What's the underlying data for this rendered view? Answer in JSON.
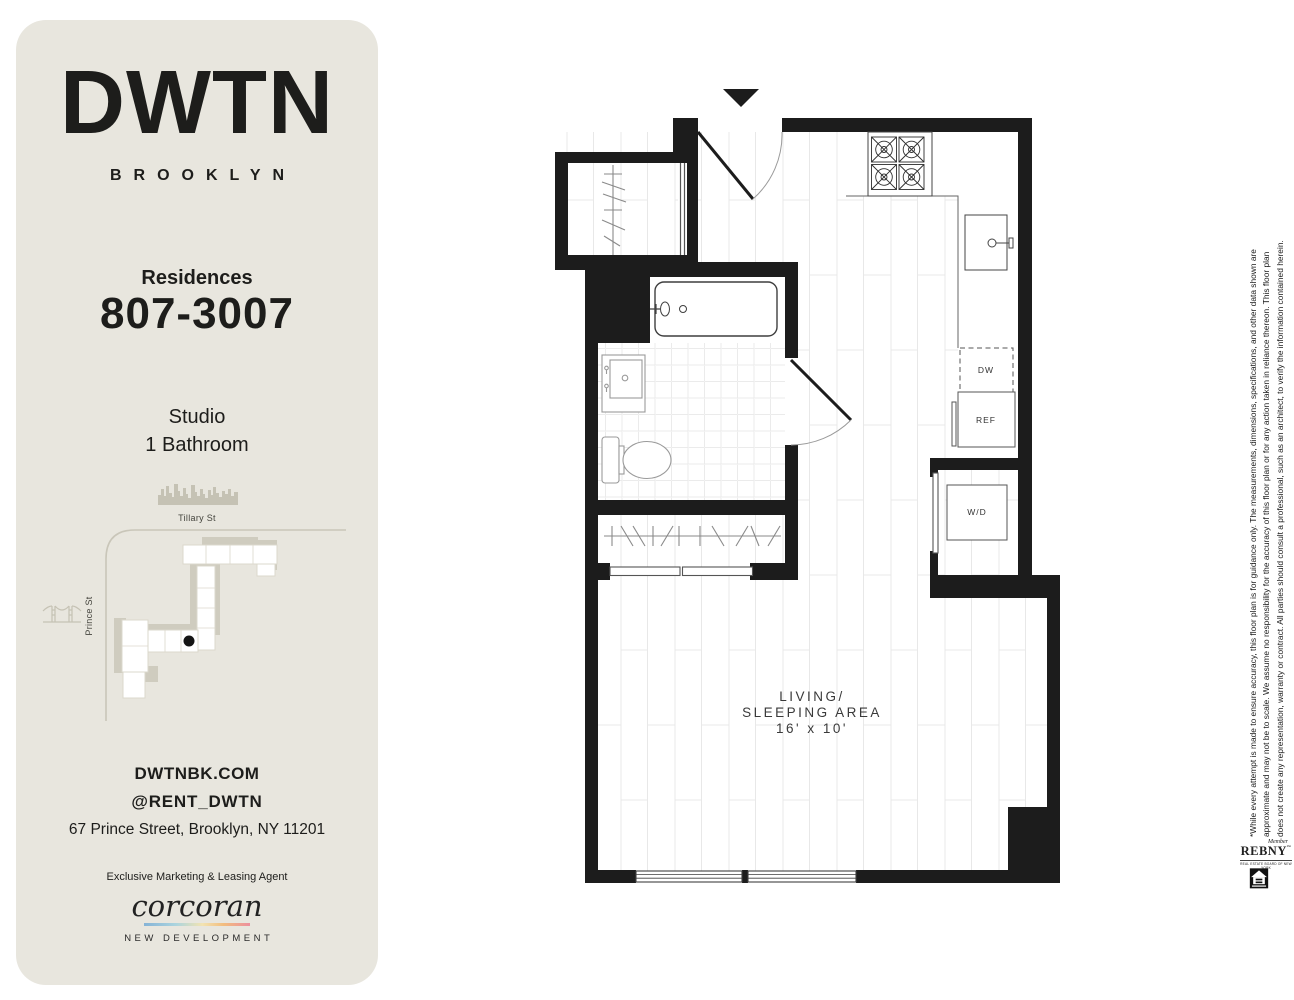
{
  "sidebar": {
    "logo": "DWTN",
    "logo_sub": "BROOKLYN",
    "residences_label": "Residences",
    "residence_range": "807-3007",
    "unit_type": "Studio",
    "bathrooms": "1 Bathroom",
    "map": {
      "street_top": "Tillary St",
      "street_left": "Prince St"
    },
    "website": "DWTNBK.COM",
    "instagram": "@RENT_DWTN",
    "address": "67 Prince Street, Brooklyn, NY 11201",
    "agent_heading": "Exclusive Marketing & Leasing Agent",
    "brokerage": "corcoran",
    "brokerage_division": "NEW DEVELOPMENT"
  },
  "floorplan": {
    "appliances": {
      "dishwasher": "DW",
      "refrigerator": "REF",
      "washer_dryer": "W/D"
    },
    "room": {
      "name_line1": "LIVING/",
      "name_line2": "SLEEPING AREA",
      "dimensions": "16' x 10'"
    }
  },
  "legal": {
    "disclaimer": [
      "*While every attempt is made to ensure accuracy, this floor plan is for guidance only. The measurements, dimensions, specifications, and other data shown are",
      "approximate and may not be to scale. We assume no responsibility for the accuracy of this floor plan or for any action taken in reliance thereon. This floor plan",
      "does not create any representation, warranty or contract. All parties should consult a professional, such as an architect, to verify the information contained herein."
    ],
    "rebny_member": "Member",
    "rebny_name": "REBNY",
    "rebny_tm": "™",
    "rebny_sub": "REAL ESTATE BOARD OF NEW YORK"
  },
  "colors": {
    "card_bg": "#e8e6de",
    "wall": "#1c1c1c",
    "map_gray": "#cfccbf",
    "accent_gradient": [
      "#85b3d6",
      "#abd4de",
      "#f2e3b2",
      "#f2bd7e",
      "#ec8f9e"
    ]
  }
}
